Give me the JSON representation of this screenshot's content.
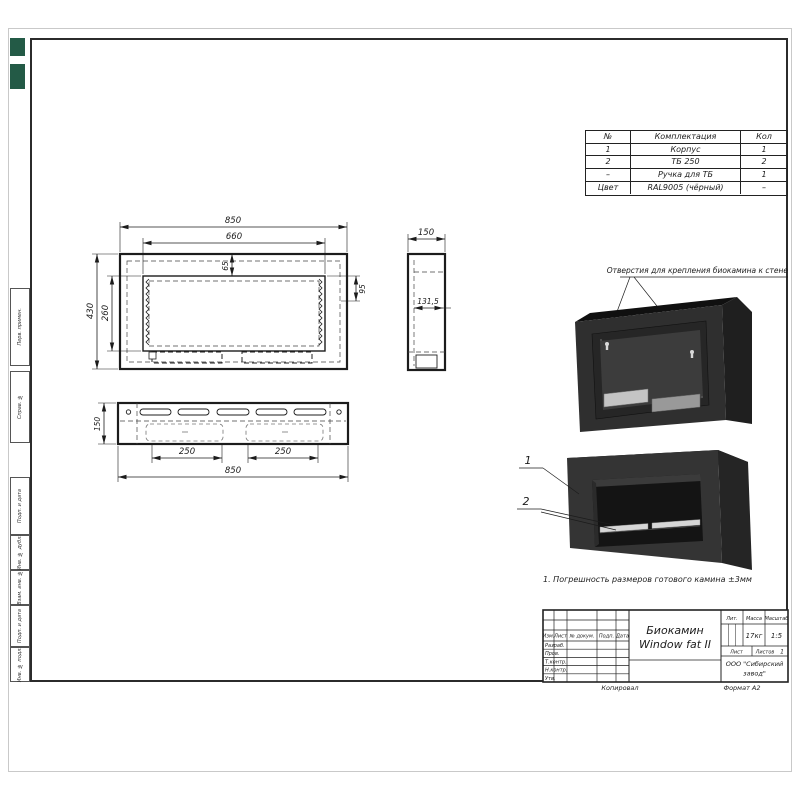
{
  "parts_table": {
    "headers": [
      "№",
      "Комплектация",
      "Кол"
    ],
    "rows": [
      [
        "1",
        "Корпус",
        "1"
      ],
      [
        "2",
        "ТБ 250",
        "2"
      ],
      [
        "–",
        "Ручка для ТБ",
        "1"
      ],
      [
        "Цвет",
        "RAL9005 (чёрный)",
        "–"
      ]
    ]
  },
  "dims": {
    "front_width": "850",
    "front_opening": "660",
    "front_top_offset": "65",
    "front_right_offset": "95",
    "front_height": "430",
    "front_opening_height": "260",
    "side_width": "150",
    "side_inner": "131,5",
    "bottom_height": "150",
    "bottom_slot_left": "250",
    "bottom_slot_right": "250",
    "bottom_width": "850"
  },
  "annotation": "Отверстия для крепления биокамина к стене",
  "note": "1. Погрешность размеров готового камина ±3мм",
  "callouts": {
    "one": "1",
    "two": "2"
  },
  "margin_boxes": [
    "Перв. примен.",
    "Справ. №",
    "Подп. и дата",
    "Инв. № дубл.",
    "Взам. инв. №",
    "Подп. и дата",
    "Инв. № подл."
  ],
  "title_block": {
    "sign_headers": [
      "Изм.",
      "Лист",
      "№ докум.",
      "Подп.",
      "Дата"
    ],
    "sign_rows": [
      "Разраб.",
      "Пров.",
      "Т.контр.",
      "Н.контр.",
      "Утв."
    ],
    "title_line1": "Биокамин",
    "title_line2": "Window fat II",
    "lit_label": "Лит.",
    "mass_label": "Масса",
    "scale_label": "Масштаб",
    "mass_value": "17кг",
    "scale_value": "1:5",
    "sheet_label": "Лист",
    "sheets_label": "Листов",
    "sheets_value": "1",
    "company_line1": "ООО \"Сибирский",
    "company_line2": "завод\"",
    "copied_label": "Копировал",
    "format_label": "Формат  А2"
  },
  "colors": {
    "drawing_line": "#1c1c1c",
    "body_dark": "#2f2f2f",
    "burner_silver": "#c4c4c4",
    "badge_green": "#235a46"
  }
}
